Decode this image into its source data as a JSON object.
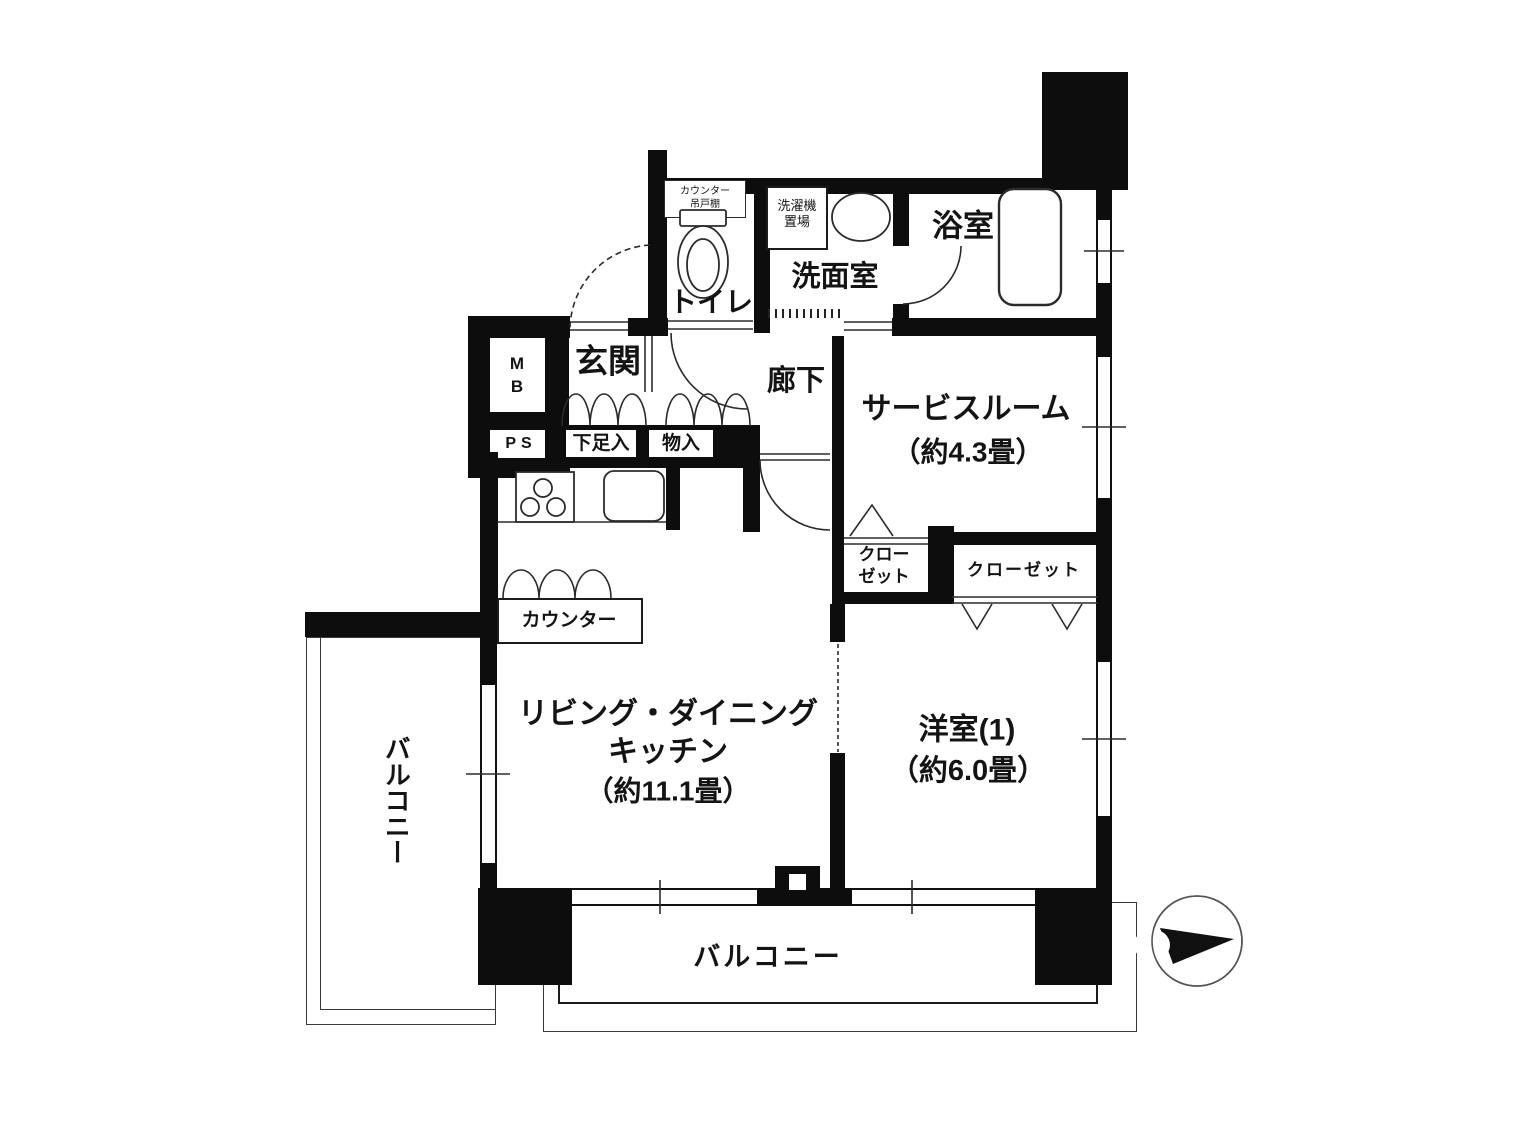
{
  "floor_plan": {
    "rooms": {
      "toilet": "トイレ",
      "washroom": "洗面室",
      "bathroom": "浴室",
      "entrance": "玄関",
      "hallway": "廊下",
      "service_room": {
        "name": "サービスルーム",
        "size": "（約4.3畳）"
      },
      "ldk": {
        "name_line1": "リビング・ダイニング",
        "name_line2": "キッチン",
        "size": "（約11.1畳）"
      },
      "western_room": {
        "name": "洋室(1)",
        "size": "（約6.0畳）"
      },
      "balcony_left": "バルコニー",
      "balcony_bottom": "バルコニー"
    },
    "labels": {
      "meter_box": {
        "line1": "M",
        "line2": "B"
      },
      "pipe_space": "PS",
      "shoe_cabinet": "下足入",
      "storage": "物入",
      "closet_left": {
        "line1": "クロー",
        "line2": "ゼット"
      },
      "closet_right": "クローゼット",
      "kitchen_counter": "カウンター",
      "washer_space": {
        "line1": "洗濯機",
        "line2": "置場"
      },
      "toilet_cupboard": {
        "line1": "カウンター",
        "line2": "吊戸棚"
      }
    },
    "colors": {
      "wall": "#0d0d0d",
      "line": "#2b2b2b",
      "background": "#ffffff"
    }
  }
}
